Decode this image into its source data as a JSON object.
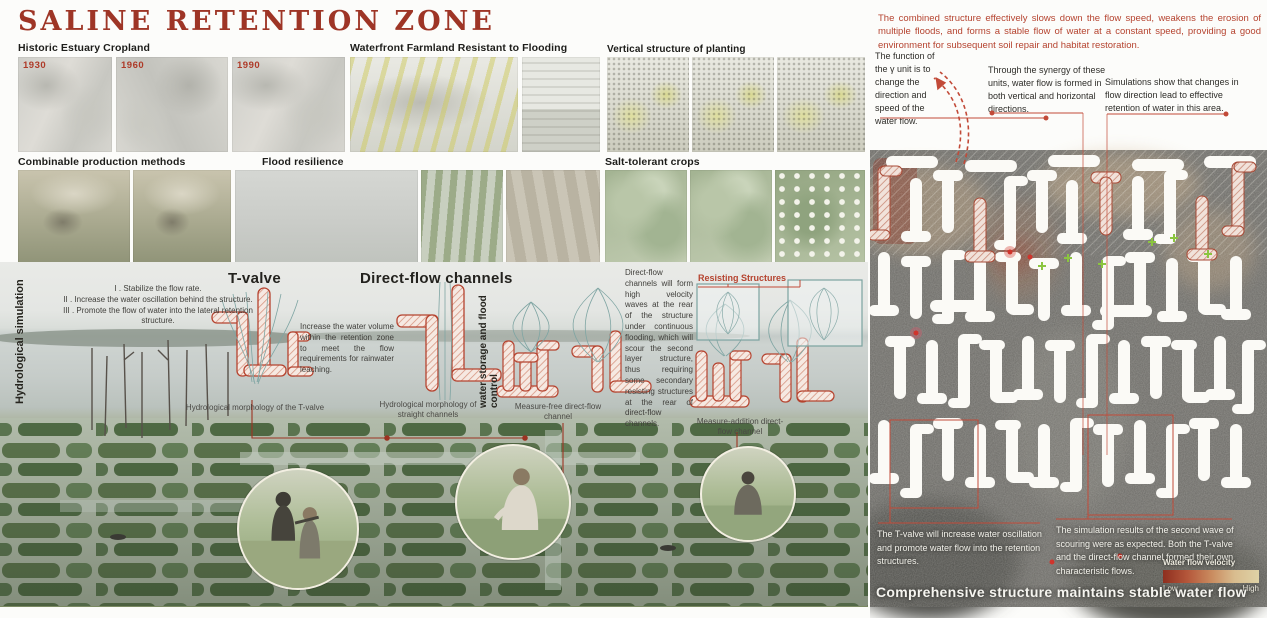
{
  "title": "SALINE RETENTION ZONE",
  "left": {
    "galleries": {
      "historic": {
        "label": "Historic Estuary Cropland",
        "years": [
          "1930",
          "1960",
          "1990"
        ]
      },
      "waterfront": {
        "label": "Waterfront Farmland Resistant to Flooding"
      },
      "vertical_planting": {
        "label": "Vertical structure of planting"
      },
      "combinable": {
        "label": "Combinable production methods"
      },
      "flood_resilience": {
        "label": "Flood resilience"
      },
      "salt_tolerant": {
        "label": "Salt-tolerant crops"
      }
    },
    "simulation": {
      "side_label": "Hydrological simulation",
      "storage_label": "water storage and flood control",
      "tvalve_heading": "T-valve",
      "tvalve_notes": [
        "I . Stabilize the flow rate.",
        "II . Increase the water oscillation behind the structure.",
        "III . Promote the flow of water into the lateral retention structure."
      ],
      "tvalve_caption": "Hydrological morphology of the T-valve",
      "direct_heading": "Direct-flow channels",
      "direct_note": "Increase the water volume within the retention zone to meet the flow requirements for rainwater leaching.",
      "direct_caption": "Hydrological morphology of straight channels",
      "measure_free_caption": "Measure-free direct-flow channel",
      "scour_note": "Direct-flow channels will form high velocity waves at the rear of the structure under continuous flooding, which will scour the second layer structure, thus requiring some secondary resisting structures at the rear of direct-flow channels.",
      "resisting_label": "Resisting Structures",
      "measure_addition_caption": "Measure-addition direct-flow channel"
    }
  },
  "right": {
    "intro": "The combined structure effectively slows down the flow speed, weakens the erosion of multiple floods, and forms a stable flow of water at a constant speed, providing a good environment for subsequent soil repair and habitat restoration.",
    "annotations": [
      "The function of the γ unit is to change the direction and speed of the water flow.",
      "Through the synergy of these units, water flow is formed in both vertical and horizontal directions.",
      "Simulations show that changes in flow direction lead to effective retention of water in this area."
    ],
    "bottom_notes": [
      "The T-valve will increase water oscillation and promote water flow into the retention structures.",
      "The simulation results of the second wave of scouring were as expected. Both the T-valve and the direct-flow channel formed their own characteristic flows."
    ],
    "legend": {
      "title": "Water flow velocity",
      "low": "Low",
      "high": "High"
    },
    "footer": "Comprehensive structure maintains stable water flow"
  },
  "colors": {
    "accent_red": "#9e3526",
    "annotation_red": "#b5432f",
    "teal": "#7ba3a0",
    "plus_green": "#8bc53f",
    "map_bg": "#6b6a66"
  }
}
